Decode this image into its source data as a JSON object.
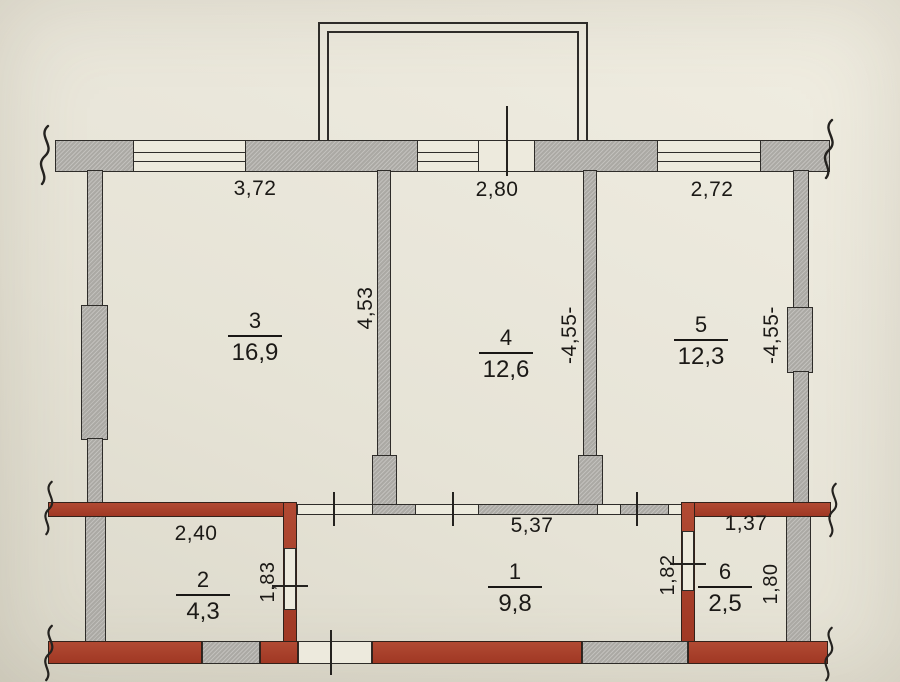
{
  "rooms": [
    {
      "number": "1",
      "area": "9,8"
    },
    {
      "number": "2",
      "area": "4,3"
    },
    {
      "number": "3",
      "area": "16,9"
    },
    {
      "number": "4",
      "area": "12,6"
    },
    {
      "number": "5",
      "area": "12,3"
    },
    {
      "number": "6",
      "area": "2,5"
    }
  ],
  "dimensions": {
    "top": [
      "3,72",
      "2,80",
      "2,72"
    ],
    "vertical_upper": [
      "4,53",
      "-4,55-",
      "-4,55-"
    ],
    "middle": [
      "2,40",
      "5,37",
      "1,37"
    ],
    "vertical_lower": [
      "1,83",
      "1,82",
      "1,80"
    ]
  },
  "colors": {
    "paper": "#e9e6da",
    "masonry_wall": "#b4b2ad",
    "brick_wall": "#a6402d",
    "ink": "#2c2a27"
  }
}
